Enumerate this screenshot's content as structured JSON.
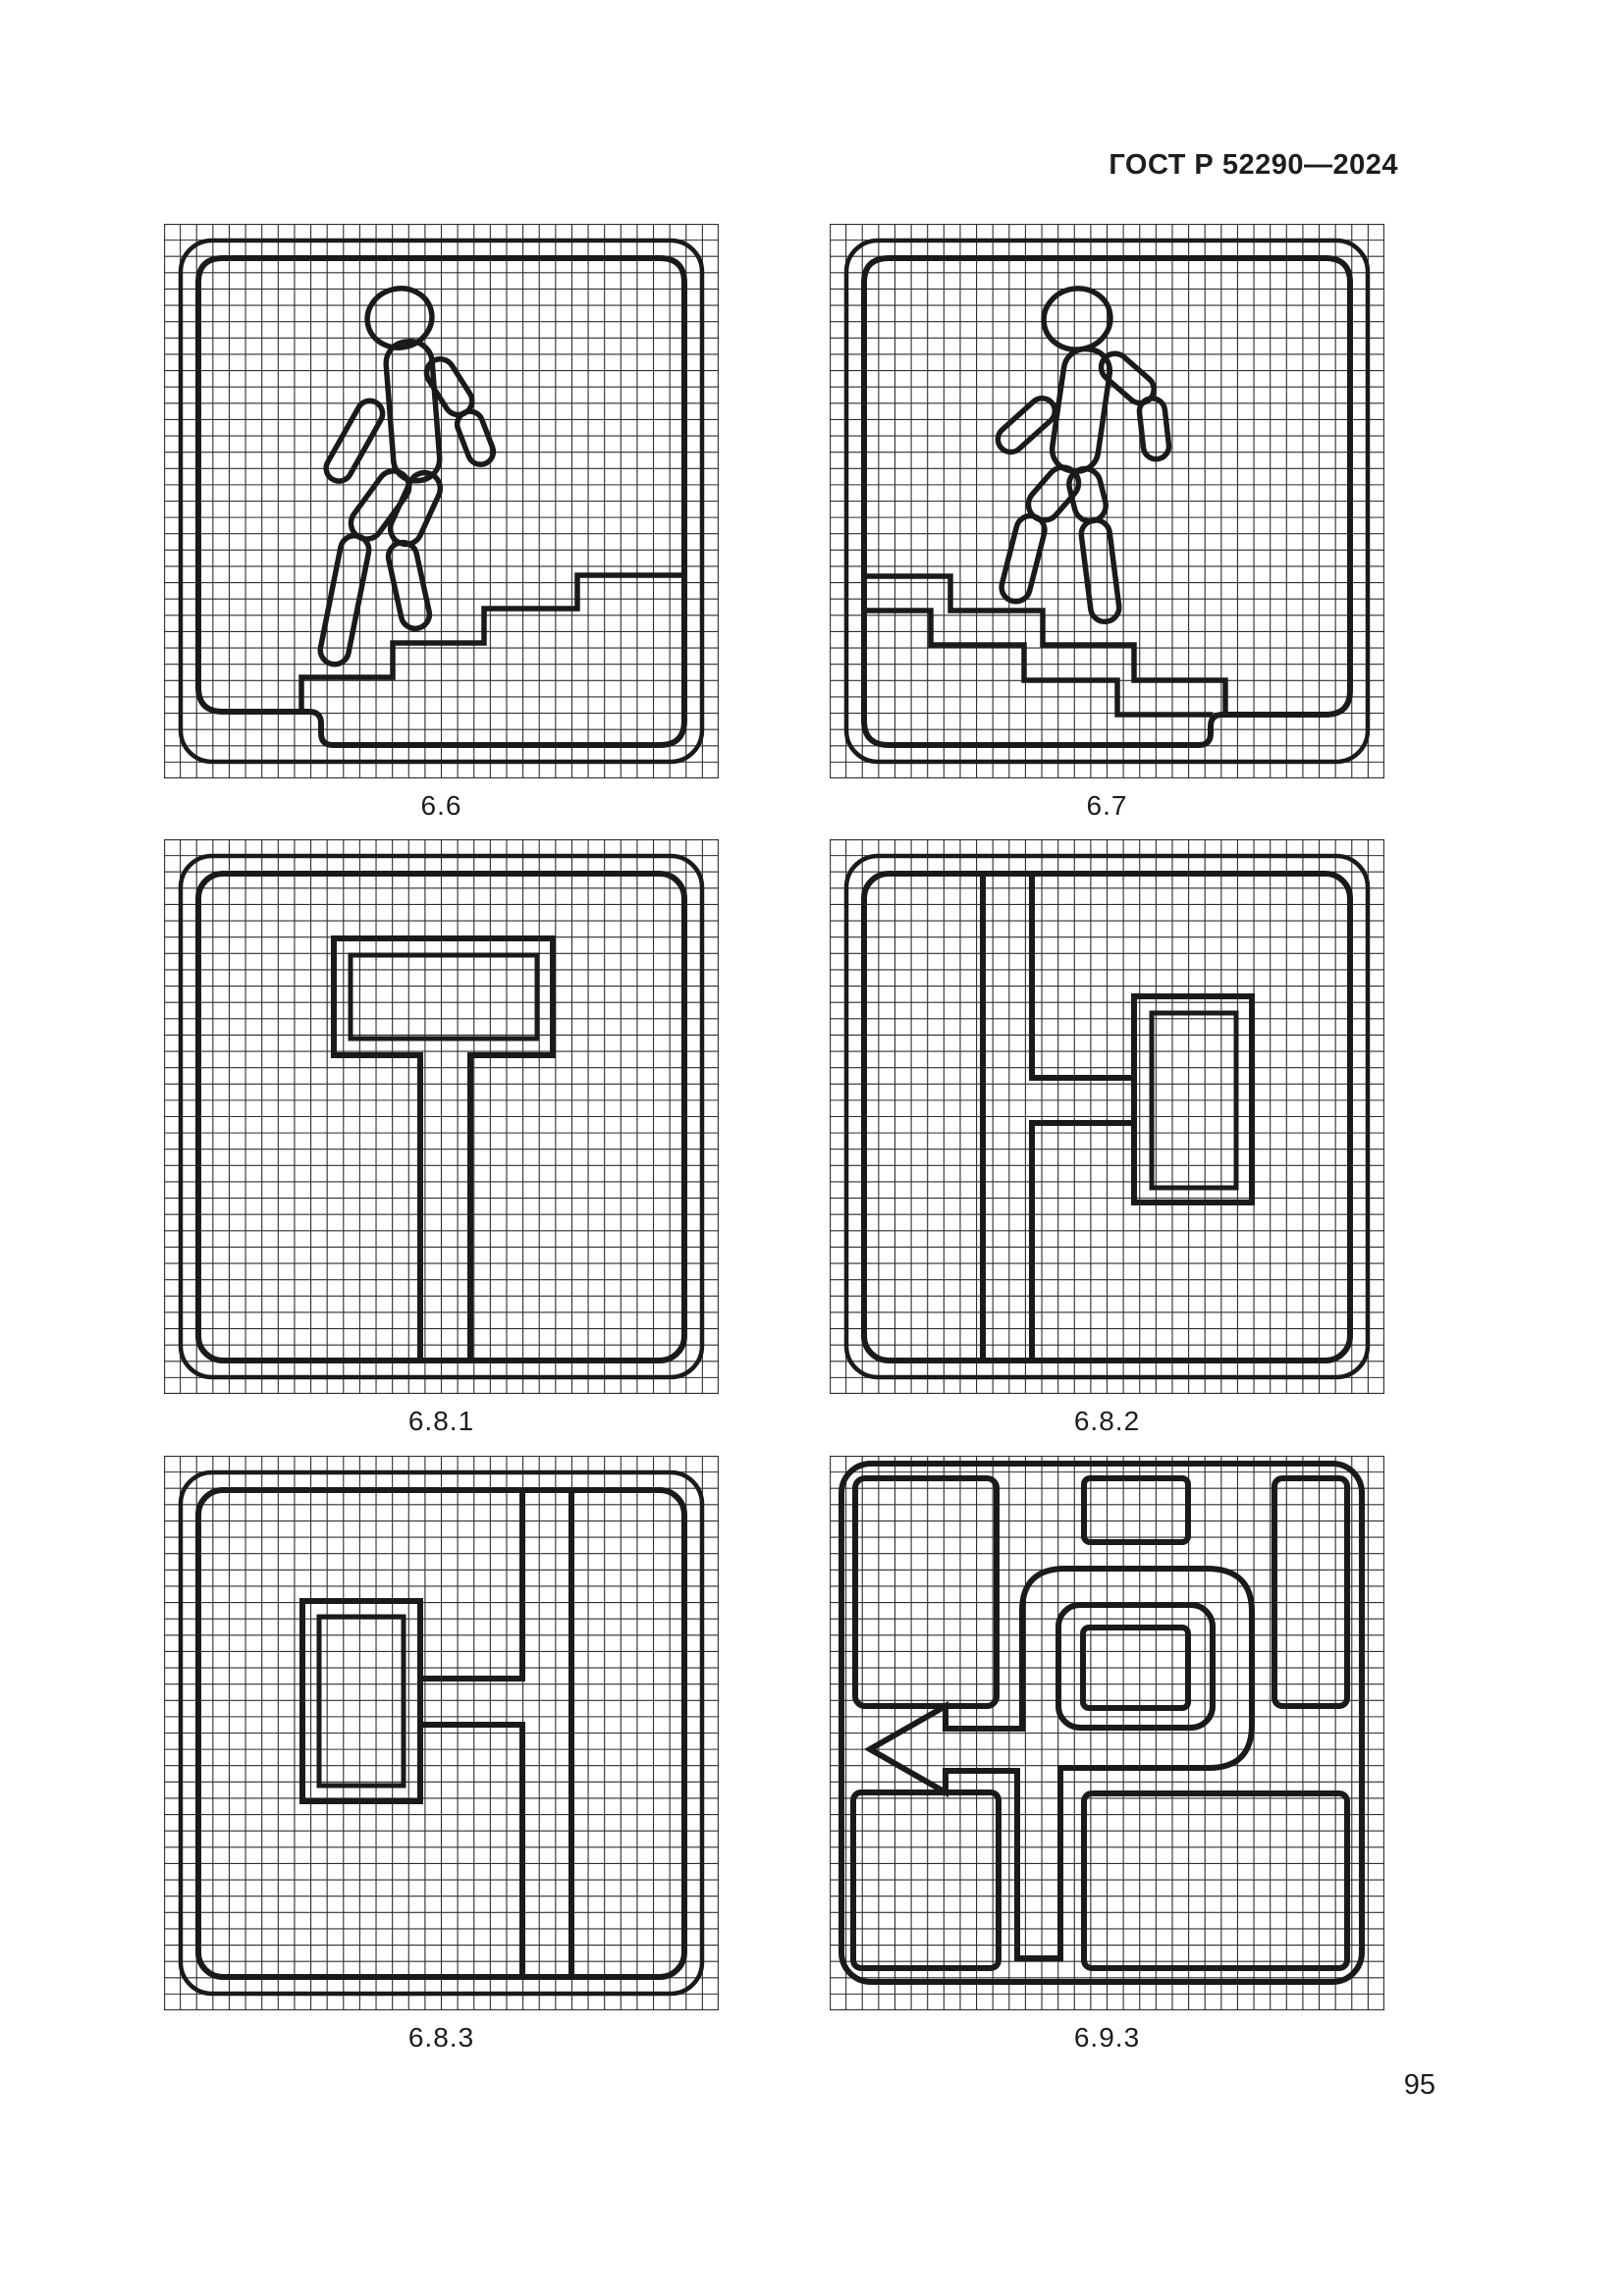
{
  "page": {
    "header": "ГОСТ Р 52290—2024",
    "page_number": "95"
  },
  "figures": [
    {
      "caption": "6.6",
      "icon": "pedestrian-descending-stairs-icon",
      "sign": "underground pedestrian crossing"
    },
    {
      "caption": "6.7",
      "icon": "pedestrian-ascending-stairs-icon",
      "sign": "overground pedestrian crossing"
    },
    {
      "caption": "6.8.1",
      "icon": "dead-end-ahead-icon",
      "sign": "dead end straight"
    },
    {
      "caption": "6.8.2",
      "icon": "dead-end-right-icon",
      "sign": "dead end to the right"
    },
    {
      "caption": "6.8.3",
      "icon": "dead-end-left-icon",
      "sign": "dead end to the left"
    },
    {
      "caption": "6.9.3",
      "icon": "detour-scheme-icon",
      "sign": "traffic scheme with left arrow"
    }
  ],
  "colors": {
    "ink": "#1a1a1a",
    "grid": "#2e2e2e",
    "background": "#ffffff"
  }
}
